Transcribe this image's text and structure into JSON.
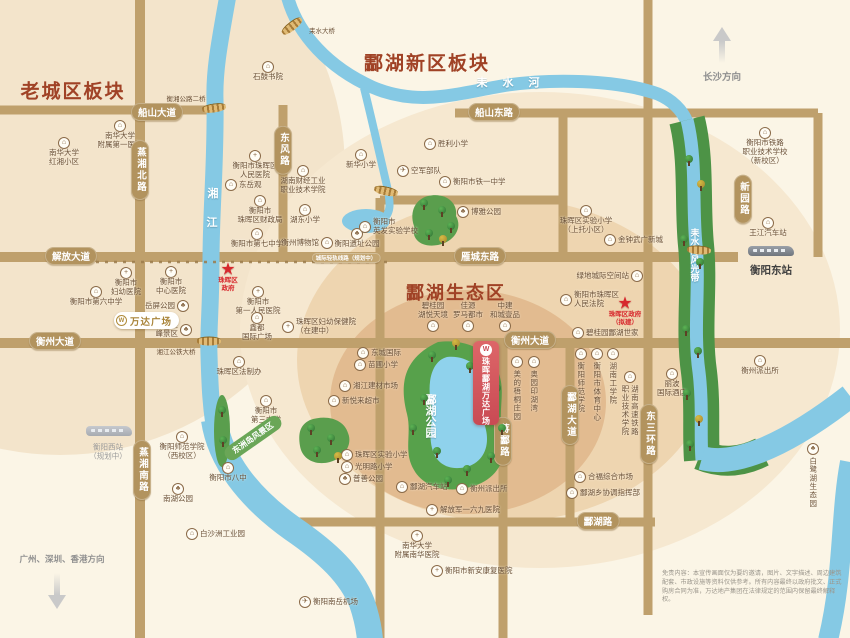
{
  "map": {
    "titles": [
      {
        "t": "老城区板块",
        "x": 73,
        "y": 90,
        "fs": 19
      },
      {
        "t": "酃湖新区板块",
        "x": 427,
        "y": 62,
        "fs": 19
      },
      {
        "t": "酃湖生态区",
        "x": 456,
        "y": 292,
        "fs": 18
      }
    ],
    "road_labels": [
      {
        "t": "船山大道",
        "x": 157,
        "y": 112
      },
      {
        "t": "船山东路",
        "x": 494,
        "y": 112
      },
      {
        "t": "解放大道",
        "x": 71,
        "y": 256
      },
      {
        "t": "雁城东路",
        "x": 480,
        "y": 256
      },
      {
        "t": "衡州大道",
        "x": 55,
        "y": 341
      },
      {
        "t": "衡州大道",
        "x": 530,
        "y": 340
      },
      {
        "t": "酃湖路",
        "x": 598,
        "y": 521
      },
      {
        "t": "蒸湘北路",
        "x": 140,
        "y": 170,
        "v": 1
      },
      {
        "t": "蒸湘南路",
        "x": 142,
        "y": 470,
        "v": 1
      },
      {
        "t": "东风路",
        "x": 283,
        "y": 150,
        "v": 1
      },
      {
        "t": "蒋酃路",
        "x": 503,
        "y": 441,
        "v": 1
      },
      {
        "t": "酃湖大道",
        "x": 570,
        "y": 415,
        "v": 1
      },
      {
        "t": "东三环路",
        "x": 649,
        "y": 434,
        "v": 1
      },
      {
        "t": "新园路",
        "x": 743,
        "y": 199,
        "v": 1
      },
      {
        "t": "城际轻轨线路（规划中）",
        "x": 346,
        "y": 258,
        "s": 1
      }
    ],
    "texts": [
      {
        "t": "耒 水 河",
        "x": 511,
        "y": 82,
        "fs": 11,
        "c": "white",
        "ls": 6
      },
      {
        "t": "湘",
        "x": 213,
        "y": 193,
        "fs": 11,
        "c": "white"
      },
      {
        "t": "江",
        "x": 212,
        "y": 222,
        "fs": 11,
        "c": "white"
      },
      {
        "t": "耒水河风光带",
        "x": 694,
        "y": 255,
        "fs": 9,
        "c": "white",
        "v": 1,
        "lh": 19
      },
      {
        "t": "酃湖公园",
        "x": 430,
        "y": 416,
        "fs": 11,
        "c": "white",
        "v": 1,
        "lh": 14
      },
      {
        "t": "湘江公铁大桥",
        "x": 176,
        "y": 351,
        "fs": 6.5,
        "c": "poi"
      },
      {
        "t": "衡湘公路二桥",
        "x": 186,
        "y": 98,
        "fs": 6.5,
        "c": "poi"
      },
      {
        "t": "耒水大桥",
        "x": 322,
        "y": 30,
        "fs": 6.5,
        "c": "poi"
      },
      {
        "t": "长沙方向",
        "x": 722,
        "y": 76,
        "fs": 9.5,
        "c": "gray"
      },
      {
        "t": "广州、深圳、香港方向",
        "x": 62,
        "y": 559,
        "fs": 8.5,
        "c": "gray"
      },
      {
        "t": "衡阳东站",
        "x": 771,
        "y": 270,
        "fs": 10.5,
        "c": "dark"
      },
      {
        "t": "衡阳西站",
        "x": 108,
        "y": 447,
        "fs": 7.5,
        "c": "gray2"
      },
      {
        "t": "（规划中）",
        "x": 108,
        "y": 456,
        "fs": 7.5,
        "c": "gray2"
      }
    ],
    "scenic_band_label": {
      "t": "东洲岛风景区",
      "x": 253,
      "y": 438
    },
    "pois": [
      {
        "x": 268,
        "y": 67,
        "g": "b",
        "lay": "b",
        "l": [
          "石鼓书院"
        ]
      },
      {
        "x": 120,
        "y": 126,
        "g": "s",
        "lay": "b",
        "l": [
          "南华大学",
          "附属第一医院"
        ]
      },
      {
        "x": 64,
        "y": 143,
        "g": "b",
        "lay": "b",
        "l": [
          "南华大学",
          "红湘小区"
        ]
      },
      {
        "x": 255,
        "y": 156,
        "g": "h",
        "lay": "b",
        "l": [
          "衡阳市珠晖区",
          "人民医院"
        ]
      },
      {
        "x": 231,
        "y": 185,
        "g": "b",
        "lay": "r",
        "l": [
          "东岳观"
        ]
      },
      {
        "x": 303,
        "y": 171,
        "g": "s",
        "lay": "b",
        "l": [
          "湖南财经工业",
          "职业技术学院"
        ]
      },
      {
        "x": 260,
        "y": 201,
        "g": "b",
        "lay": "b",
        "l": [
          "衡阳市",
          "珠晖区财政局"
        ]
      },
      {
        "x": 305,
        "y": 210,
        "g": "s",
        "lay": "b",
        "l": [
          "湖东小学"
        ]
      },
      {
        "x": 257,
        "y": 234,
        "g": "s",
        "lay": "b",
        "l": [
          "衡阳市第七中学"
        ]
      },
      {
        "x": 327,
        "y": 243,
        "g": "b",
        "lay": "l",
        "l": [
          "衡州博物馆"
        ]
      },
      {
        "x": 357,
        "y": 234,
        "g": "p",
        "lay": "b",
        "l": [
          "衡阳遗址公园"
        ]
      },
      {
        "x": 365,
        "y": 224,
        "g": "s",
        "lay": "r",
        "l": [
          "衡阳市",
          "英发实验学校"
        ]
      },
      {
        "x": 361,
        "y": 155,
        "g": "s",
        "lay": "b",
        "l": [
          "新华小学"
        ]
      },
      {
        "x": 430,
        "y": 144,
        "g": "s",
        "lay": "r",
        "l": [
          "胜利小学"
        ]
      },
      {
        "x": 403,
        "y": 171,
        "g": "pl",
        "lay": "r",
        "l": [
          "空军部队"
        ]
      },
      {
        "x": 445,
        "y": 182,
        "g": "s",
        "lay": "r",
        "l": [
          "衡阳市铁一中学"
        ]
      },
      {
        "x": 463,
        "y": 212,
        "g": "p",
        "lay": "r",
        "l": [
          "博雅公园"
        ]
      },
      {
        "x": 765,
        "y": 133,
        "g": "s",
        "lay": "b",
        "l": [
          "衡阳市铁路",
          "职业技术学校",
          "（新校区）"
        ]
      },
      {
        "x": 768,
        "y": 223,
        "g": "b",
        "lay": "b",
        "l": [
          "王江汽车站"
        ]
      },
      {
        "x": 586,
        "y": 211,
        "g": "s",
        "lay": "b",
        "l": [
          "珠晖区实验小学",
          "（上托小区）"
        ]
      },
      {
        "x": 610,
        "y": 240,
        "g": "b",
        "lay": "r",
        "l": [
          "金钟武广新城"
        ]
      },
      {
        "x": 637,
        "y": 276,
        "g": "b",
        "lay": "l",
        "l": [
          "绿地城际空间站"
        ]
      },
      {
        "x": 566,
        "y": 297,
        "g": "b",
        "lay": "r",
        "l": [
          "衡阳市珠晖区",
          "人民法院"
        ]
      },
      {
        "x": 578,
        "y": 333,
        "g": "b",
        "lay": "r",
        "l": [
          "碧桂园酃湖世家"
        ]
      },
      {
        "x": 581,
        "y": 354,
        "g": "s",
        "lay": "vb",
        "l": [
          "衡阳师范学院"
        ]
      },
      {
        "x": 597,
        "y": 354,
        "g": "s",
        "lay": "vb",
        "l": [
          "衡阳市体育中心"
        ]
      },
      {
        "x": 613,
        "y": 354,
        "g": "s",
        "lay": "vb",
        "l": [
          "湖南工学院"
        ]
      },
      {
        "x": 630,
        "y": 377,
        "g": "s",
        "lay": "vb",
        "l": [
          "湖南高速铁路",
          "职业技术学院"
        ]
      },
      {
        "x": 672,
        "y": 374,
        "g": "b",
        "lay": "b",
        "l": [
          "丽波",
          "国际酒店"
        ]
      },
      {
        "x": 760,
        "y": 361,
        "g": "b",
        "lay": "b",
        "l": [
          "衡州派出所"
        ]
      },
      {
        "x": 813,
        "y": 449,
        "g": "p",
        "lay": "vb",
        "l": [
          "白鹭湖生态园"
        ]
      },
      {
        "x": 580,
        "y": 477,
        "g": "m",
        "lay": "r",
        "l": [
          "合福综合市场"
        ]
      },
      {
        "x": 572,
        "y": 493,
        "g": "b",
        "lay": "r",
        "l": [
          "酃湖乡协调指挥部"
        ]
      },
      {
        "x": 462,
        "y": 489,
        "g": "b",
        "lay": "r",
        "l": [
          "衡州派出所"
        ]
      },
      {
        "x": 432,
        "y": 510,
        "g": "h",
        "lay": "r",
        "l": [
          "解放军一六九医院"
        ]
      },
      {
        "x": 402,
        "y": 487,
        "g": "b",
        "lay": "r",
        "l": [
          "酃湖汽车站"
        ]
      },
      {
        "x": 347,
        "y": 455,
        "g": "s",
        "lay": "r",
        "l": [
          "珠晖区实验小学"
        ]
      },
      {
        "x": 347,
        "y": 467,
        "g": "s",
        "lay": "r",
        "l": [
          "光明路小学"
        ]
      },
      {
        "x": 345,
        "y": 479,
        "g": "p",
        "lay": "r",
        "l": [
          "普善公园"
        ]
      },
      {
        "x": 417,
        "y": 536,
        "g": "h",
        "lay": "b",
        "l": [
          "南华大学",
          "附属南华医院"
        ]
      },
      {
        "x": 437,
        "y": 571,
        "g": "h",
        "lay": "r",
        "l": [
          "衡阳市新安康复医院"
        ]
      },
      {
        "x": 305,
        "y": 602,
        "g": "pl",
        "lay": "r",
        "l": [
          "衡阳南岳机场"
        ]
      },
      {
        "x": 228,
        "y": 468,
        "g": "s",
        "lay": "b",
        "l": [
          "衡阳市八中"
        ]
      },
      {
        "x": 182,
        "y": 437,
        "g": "s",
        "lay": "b",
        "l": [
          "衡阳师范学院",
          "（西校区）"
        ]
      },
      {
        "x": 178,
        "y": 489,
        "g": "p",
        "lay": "b",
        "l": [
          "南湖公园"
        ]
      },
      {
        "x": 192,
        "y": 534,
        "g": "b",
        "lay": "r",
        "l": [
          "白沙洲工业园"
        ]
      },
      {
        "x": 363,
        "y": 353,
        "g": "b",
        "lay": "r",
        "l": [
          "东城国际"
        ]
      },
      {
        "x": 360,
        "y": 365,
        "g": "s",
        "lay": "r",
        "l": [
          "苗圃小学"
        ]
      },
      {
        "x": 345,
        "y": 386,
        "g": "m",
        "lay": "r",
        "l": [
          "湘江建材市场"
        ]
      },
      {
        "x": 334,
        "y": 401,
        "g": "m",
        "lay": "r",
        "l": [
          "新悦来超市"
        ]
      },
      {
        "x": 288,
        "y": 324,
        "g": "h",
        "lay": "r",
        "l": [
          "珠晖区妇幼保健院",
          "（在建中）"
        ]
      },
      {
        "x": 186,
        "y": 327,
        "g": "p",
        "lay": "l",
        "l": [
          "回雁",
          "峰景区"
        ]
      },
      {
        "x": 183,
        "y": 306,
        "g": "p",
        "lay": "l",
        "l": [
          "岳屏公园"
        ]
      },
      {
        "x": 171,
        "y": 272,
        "g": "h",
        "lay": "b",
        "l": [
          "衡阳市",
          "中心医院"
        ]
      },
      {
        "x": 126,
        "y": 273,
        "g": "h",
        "lay": "b",
        "l": [
          "衡阳市",
          "妇幼医院"
        ]
      },
      {
        "x": 96,
        "y": 292,
        "g": "s",
        "lay": "b",
        "l": [
          "衡阳市第六中学"
        ]
      },
      {
        "x": 258,
        "y": 292,
        "g": "h",
        "lay": "b",
        "l": [
          "衡阳市",
          "第一人民医院"
        ]
      },
      {
        "x": 257,
        "y": 318,
        "g": "b",
        "lay": "b",
        "l": [
          "鑫都",
          "国际广场"
        ]
      },
      {
        "x": 239,
        "y": 362,
        "g": "b",
        "lay": "b",
        "l": [
          "珠晖区法制办"
        ]
      },
      {
        "x": 266,
        "y": 401,
        "g": "s",
        "lay": "b",
        "l": [
          "衡阳市",
          "第三中学"
        ]
      },
      {
        "x": 517,
        "y": 362,
        "g": "b",
        "lay": "vb",
        "l": [
          "美的梧桐庄园"
        ]
      },
      {
        "x": 534,
        "y": 362,
        "g": "b",
        "lay": "vb",
        "l": [
          "奥园印湖湾"
        ]
      },
      {
        "x": 433,
        "y": 328,
        "g": "b",
        "lay": "ta",
        "l": [
          "碧桂园",
          "湖悦天境"
        ]
      },
      {
        "x": 468,
        "y": 328,
        "g": "b",
        "lay": "ta",
        "l": [
          "佳源",
          "罗马都市"
        ]
      },
      {
        "x": 505,
        "y": 328,
        "g": "b",
        "lay": "ta",
        "l": [
          "中建",
          "和城壹品"
        ]
      }
    ],
    "stars": [
      {
        "x": 228,
        "y": 269,
        "l": [
          "珠晖区",
          "政府"
        ]
      },
      {
        "x": 625,
        "y": 303,
        "l": [
          "珠晖区政府",
          "（拟建）"
        ]
      }
    ],
    "badges": {
      "project": "珠晖酃湖万达广场",
      "wanda_plaza": "万达广场",
      "logo_letter": "W"
    },
    "trains": [
      {
        "x": 771,
        "y": 251,
        "dark": 1
      },
      {
        "x": 109,
        "y": 431,
        "dark": 0
      }
    ],
    "arrows": [
      {
        "x": 722,
        "y": 27,
        "d": "up"
      },
      {
        "x": 57,
        "y": 573,
        "d": "down"
      }
    ],
    "bridges": [
      {
        "x": 292,
        "y": 26,
        "r": -38
      },
      {
        "x": 214,
        "y": 108,
        "r": -8
      },
      {
        "x": 386,
        "y": 191,
        "r": 12
      },
      {
        "x": 209,
        "y": 341,
        "r": 0
      },
      {
        "x": 699,
        "y": 250,
        "r": 4
      }
    ],
    "trees": [
      {
        "x": 689,
        "y": 160
      },
      {
        "x": 701,
        "y": 185,
        "c": "y"
      },
      {
        "x": 684,
        "y": 240
      },
      {
        "x": 700,
        "y": 263
      },
      {
        "x": 686,
        "y": 330
      },
      {
        "x": 698,
        "y": 352
      },
      {
        "x": 687,
        "y": 394
      },
      {
        "x": 699,
        "y": 420,
        "c": "y"
      },
      {
        "x": 690,
        "y": 445
      },
      {
        "x": 432,
        "y": 356
      },
      {
        "x": 470,
        "y": 367
      },
      {
        "x": 497,
        "y": 389
      },
      {
        "x": 424,
        "y": 399
      },
      {
        "x": 502,
        "y": 429
      },
      {
        "x": 437,
        "y": 452
      },
      {
        "x": 467,
        "y": 470
      },
      {
        "x": 491,
        "y": 457
      },
      {
        "x": 448,
        "y": 481
      },
      {
        "x": 413,
        "y": 429
      },
      {
        "x": 456,
        "y": 344,
        "c": "y"
      },
      {
        "x": 424,
        "y": 204
      },
      {
        "x": 442,
        "y": 211
      },
      {
        "x": 451,
        "y": 227
      },
      {
        "x": 429,
        "y": 234
      },
      {
        "x": 443,
        "y": 240,
        "c": "y"
      },
      {
        "x": 311,
        "y": 429
      },
      {
        "x": 331,
        "y": 439
      },
      {
        "x": 317,
        "y": 451
      },
      {
        "x": 338,
        "y": 457,
        "c": "y"
      },
      {
        "x": 222,
        "y": 411
      },
      {
        "x": 223,
        "y": 441
      }
    ],
    "rivers": {
      "xiangjiang": "湘江",
      "leishui_he": "耒水河",
      "leishui_band": "耒水河风光带",
      "linghu_park": "酃湖公园"
    },
    "colors": {
      "road": "#bfa06c",
      "river": "#85c9e4",
      "green_band": "#4d9346",
      "park": "#57a14b",
      "lake": "#8fd2ec",
      "accent_red": "#d7282d",
      "badge_red": "#d05059",
      "title_red": "#a04226",
      "pill": "#b2935e"
    },
    "disclaimer": "免责内容：本宣传画面仅为要约邀请，图片、文字描述、周边建筑配套、市政设施等资料仅供参考。所有内容最终以政府批文、正式购房合同为准，万达地产集团在法律规定的范围内保留最终解释权。"
  }
}
